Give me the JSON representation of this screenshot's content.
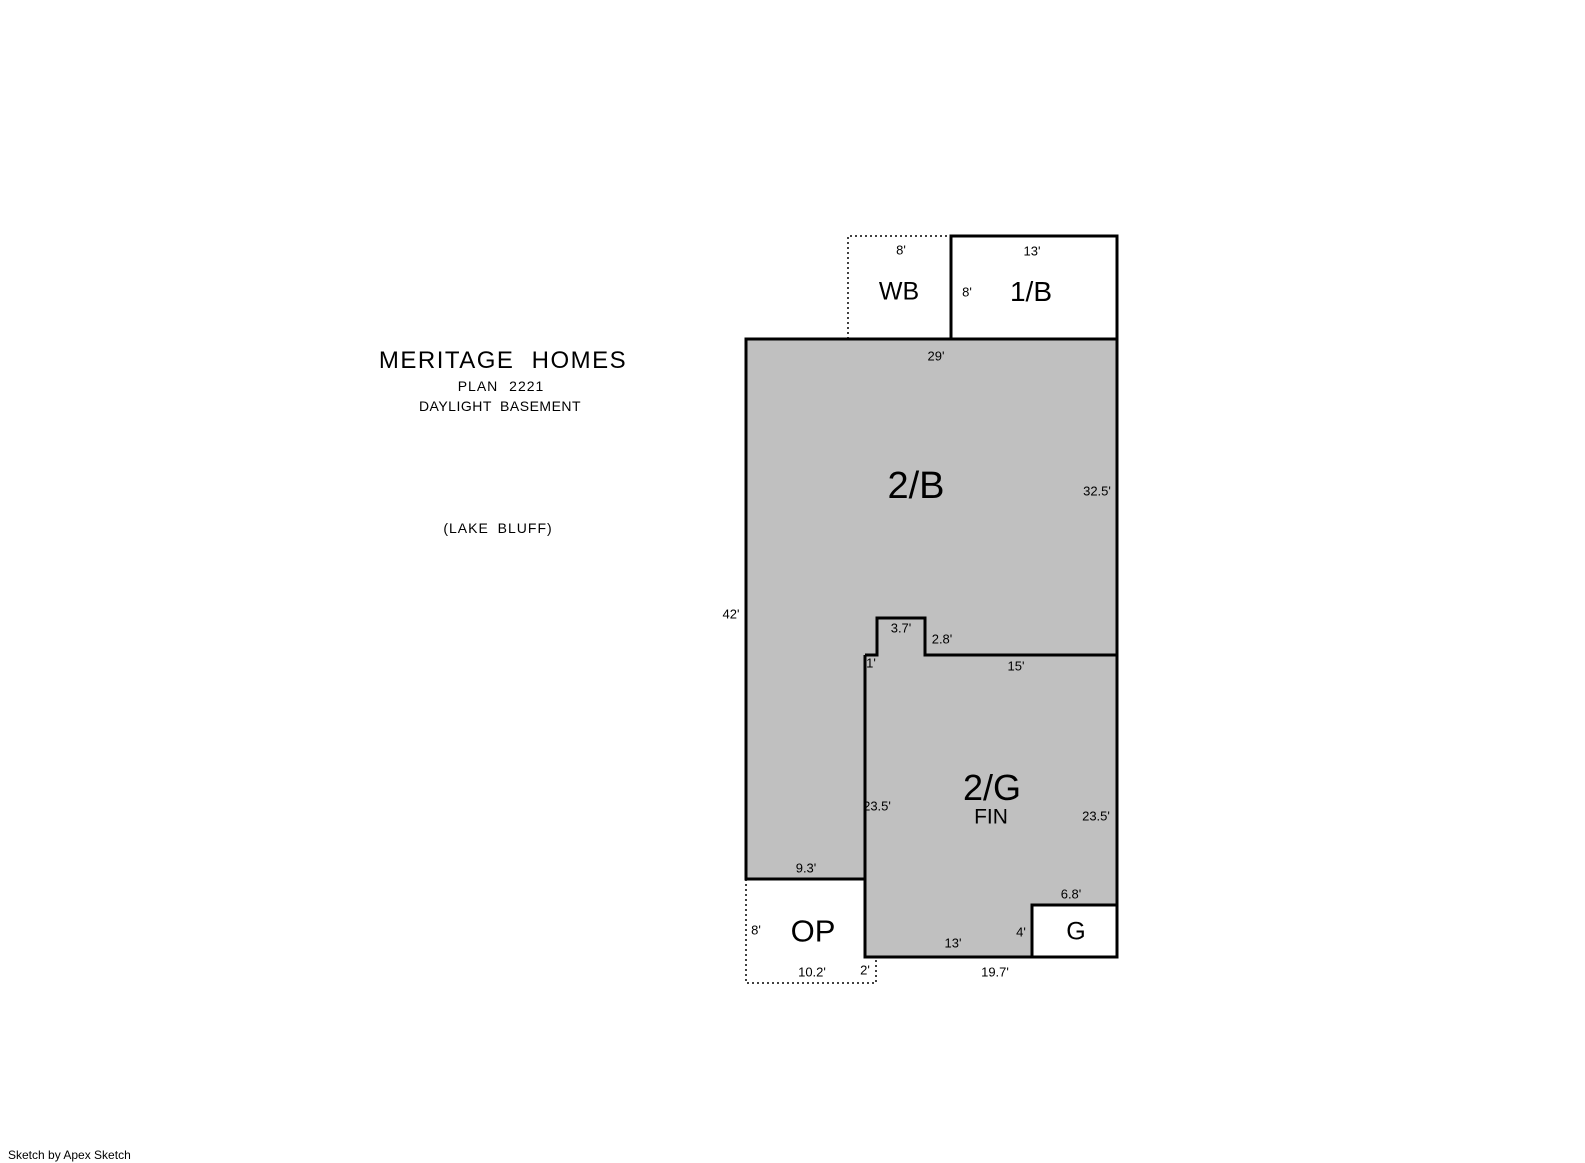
{
  "title": {
    "company": "MERITAGE HOMES",
    "plan": "PLAN 2221",
    "subtitle": "DAYLIGHT BASEMENT",
    "note": "(LAKE BLUFF)"
  },
  "footer": {
    "credit": "Sketch by Apex Sketch"
  },
  "colors": {
    "area_fill": "#c0c0c0",
    "line": "#000000",
    "background": "#ffffff"
  },
  "areas": {
    "wb": {
      "label": "WB",
      "width_top": "8'"
    },
    "b1": {
      "label": "1/B",
      "width_top": "13'",
      "height_left": "8'"
    },
    "b2": {
      "label": "2/B",
      "width_top": "29'",
      "height_left": "42'",
      "height_right": "32.5'",
      "notch_width": "3.7'",
      "notch_height": "2.8'",
      "notch_step": "1'",
      "bottom_right_width": "15'",
      "bottom_left_width": "9.3'"
    },
    "g2": {
      "label": "2/G",
      "sublabel": "FIN",
      "height_left": "23.5'",
      "height_right": "23.5'",
      "bottom_width": "13'",
      "bottom_total_width": "19.7'"
    },
    "op": {
      "label": "OP",
      "height_left": "8'",
      "bottom_width": "10.2'",
      "height_right": "2'"
    },
    "g": {
      "label": "G",
      "width_top": "6.8'",
      "height_left": "4'"
    }
  }
}
